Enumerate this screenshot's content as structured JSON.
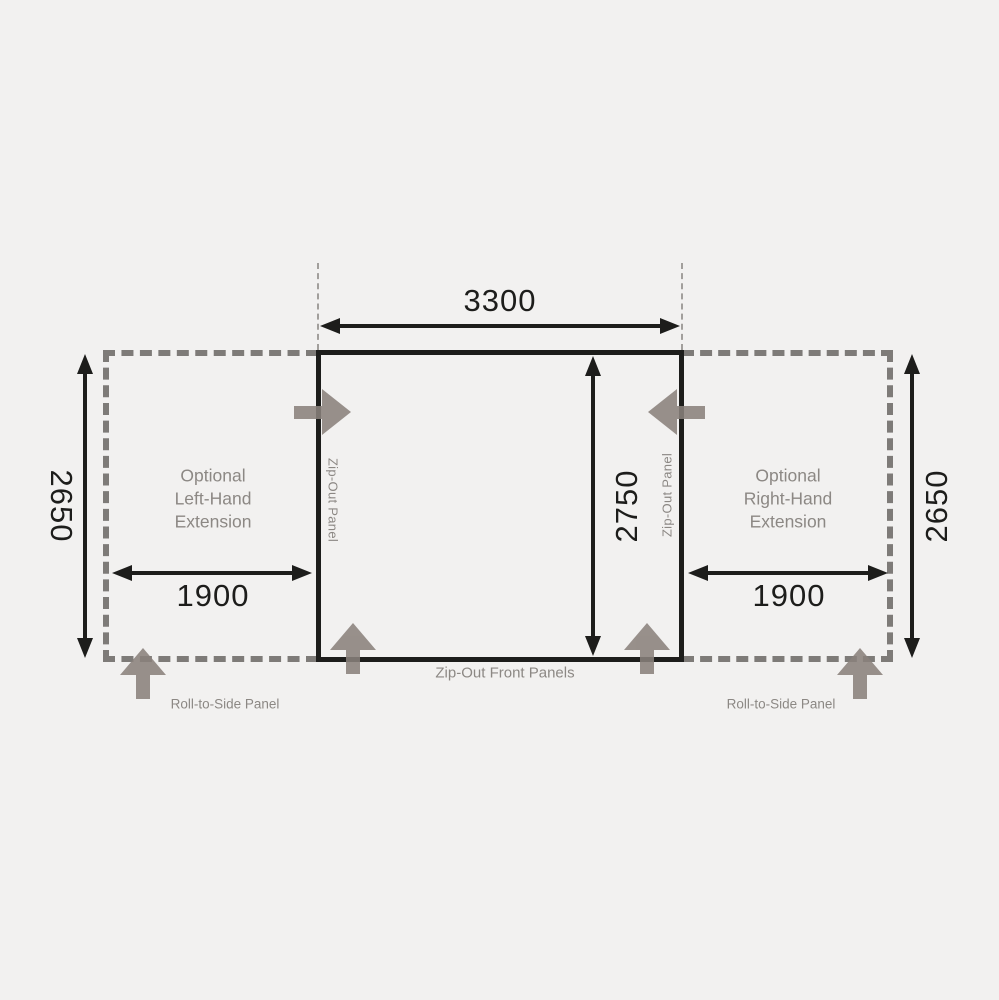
{
  "diagram": {
    "type": "awning-floorplan-dimension-diagram",
    "dims": {
      "main_width": "3300",
      "main_depth": "2750",
      "left_ext_height": "2650",
      "right_ext_height": "2650",
      "left_ext_width": "1900",
      "right_ext_width": "1900"
    },
    "labels": {
      "left_extension": "Optional\nLeft-Hand\nExtension",
      "right_extension": "Optional\nRight-Hand\nExtension",
      "zip_out_panel_left": "Zip-Out Panel",
      "zip_out_panel_right": "Zip-Out Panel",
      "zip_out_front_panels": "Zip-Out Front Panels",
      "roll_to_side_left": "Roll-to-Side Panel",
      "roll_to_side_right": "Roll-to-Side Panel"
    },
    "colors": {
      "background": "#f2f1f0",
      "outline_black": "#1d1d1b",
      "dashed_gray": "#7e7b78",
      "text_gray": "#8c8884",
      "arrow_gray": "#8a817c"
    }
  }
}
